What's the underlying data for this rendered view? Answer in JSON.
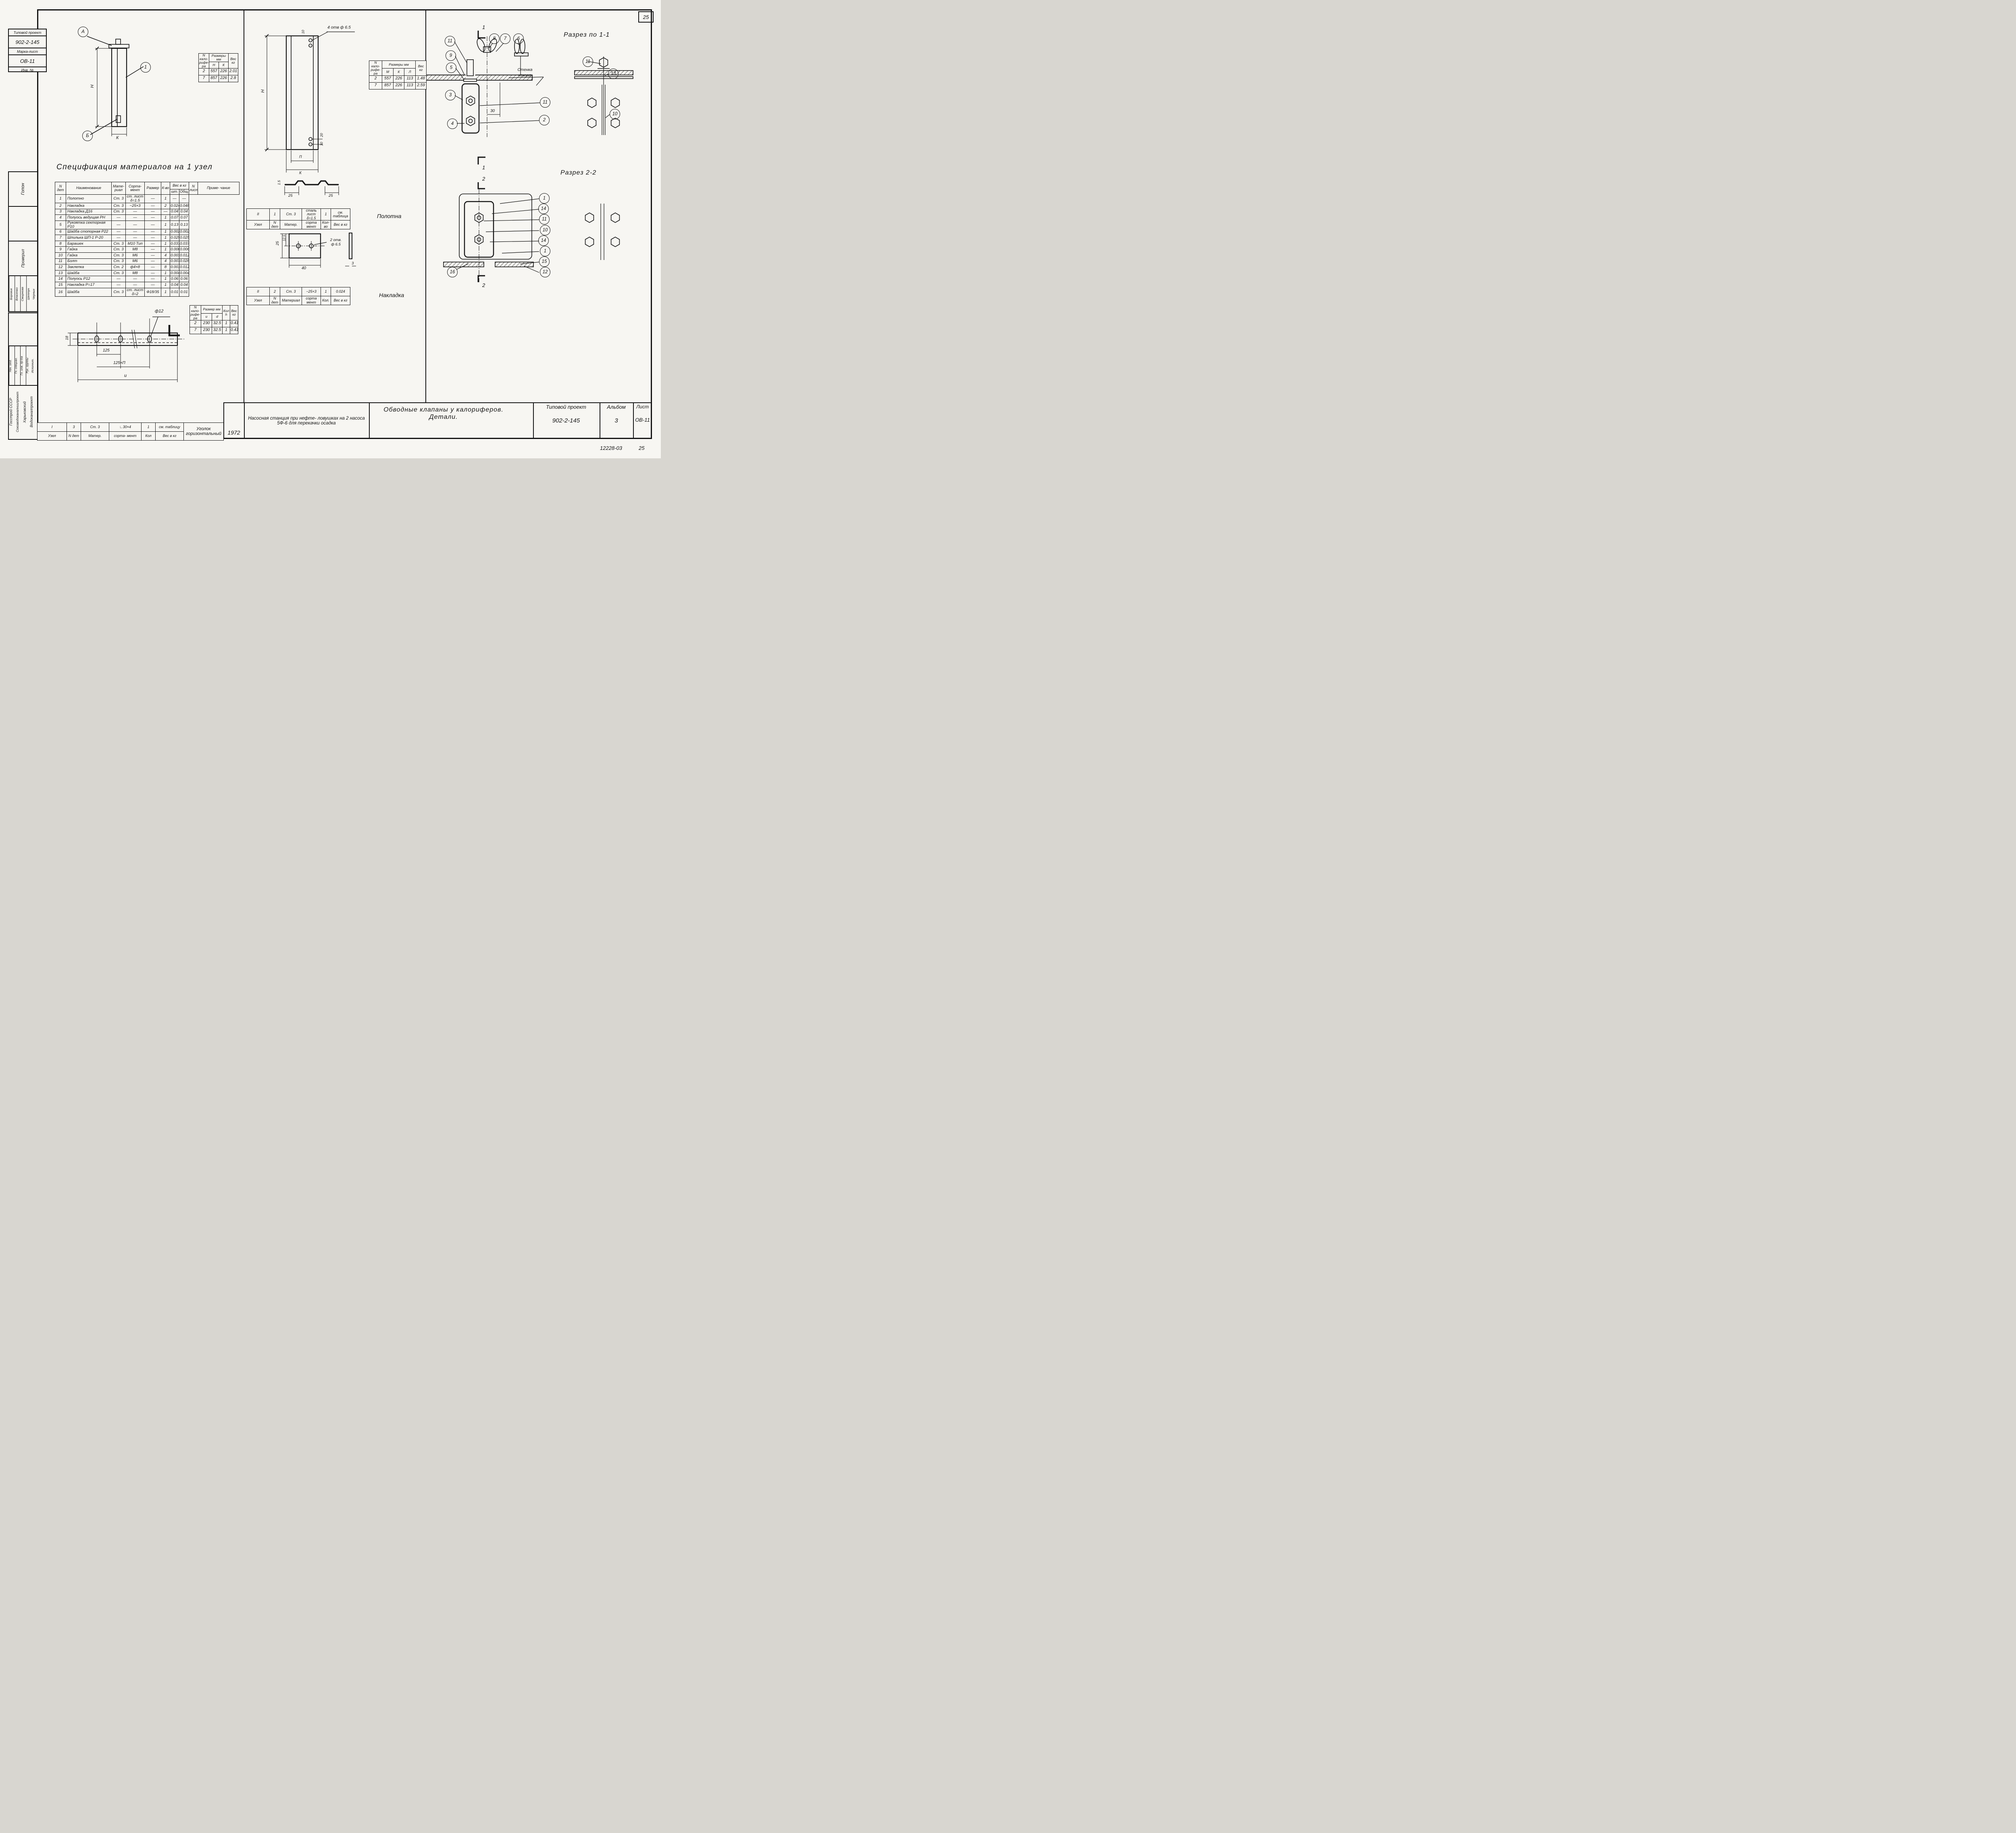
{
  "sheet": {
    "corner_number": "25",
    "footer_code": "12228-03",
    "footer_page": "25"
  },
  "corner_stamp": {
    "line1": "Типовой проект",
    "line2": "902-2-145",
    "line3": "Марка-лист",
    "line4": "ОВ-11",
    "line5": "Инв. №"
  },
  "left_stamp": {
    "approver": "Гопон",
    "checked_label": "Проверил",
    "names": [
      "Боровик",
      "Власенко",
      "Смирнова",
      "Шептун",
      "Черных"
    ],
    "roles": [
      "Нач. отд.",
      "Гл. специал.",
      "Гл. инж. пр-та",
      "Рук. группы",
      "Исполнит."
    ],
    "org": [
      "Госстрой СССР",
      "Союзводоканалниипроект",
      "Харьковский",
      "Водоканалпроект"
    ]
  },
  "spec": {
    "title": "Спецификация материалов на 1 узел",
    "h_num": "N дет",
    "h_name": "Наименование",
    "h_mat": "Мате- риал",
    "h_sort": "Сорта- мент",
    "h_size": "Размер",
    "h_qty": "К-во",
    "h_weight": "Вес в кг",
    "h_w_ea": "шт.",
    "h_w_tot": "Общ.",
    "h_sheet": "N листа",
    "h_note": "Приме- чание",
    "rows": [
      [
        "1",
        "Полотно",
        "Ст. 3",
        "ст. лист δ=1.5",
        "—",
        "1",
        "—",
        "—"
      ],
      [
        "2",
        "Накладка",
        "Ст. 3",
        "−25×3",
        "—",
        "2",
        "0.024",
        "0.048"
      ],
      [
        "3",
        "Накладка Д16",
        "Ст. 3",
        "—",
        "—",
        "—",
        "0.04",
        "0.04"
      ],
      [
        "4",
        "Полуось ведущая РН",
        "—",
        "—",
        "—",
        "1",
        "0.07",
        "0.07"
      ],
      [
        "5",
        "Рукоятка секторная Р10",
        "—",
        "—",
        "—",
        "1",
        "0.13",
        "0.13"
      ],
      [
        "6",
        "Шайба стопорная Р22",
        "—",
        "—",
        "—",
        "1",
        "0.002",
        "0.002"
      ],
      [
        "7",
        "Шпилька ШП-1 Р-20",
        "—",
        "—",
        "—",
        "1",
        "0.025",
        "0.025"
      ],
      [
        "8",
        "Барашек",
        "Ст. 3",
        "М10 Тип",
        "—",
        "1",
        "0.037",
        "0.037"
      ],
      [
        "9",
        "Гайка",
        "Ст. 3",
        "М8",
        "—",
        "1",
        "0.006",
        "0.006"
      ],
      [
        "10",
        "Гайка",
        "Ст. 3",
        "М6",
        "—",
        "4",
        "0.003",
        "0.012"
      ],
      [
        "11",
        "Болт",
        "Ст. 3",
        "М6",
        "—",
        "4",
        "0.007",
        "0.028"
      ],
      [
        "12",
        "Заклепка",
        "Ст. 2",
        "ф4×8",
        "—",
        "8",
        "0.0015",
        "0.012"
      ],
      [
        "13",
        "Шайба",
        "Ст. 3",
        "М8",
        "—",
        "1",
        "0.004",
        "0.004"
      ],
      [
        "14",
        "Полуось Р12",
        "—",
        "—",
        "—",
        "1",
        "0.06",
        "0.06"
      ],
      [
        "15",
        "Накладка Р=17",
        "—",
        "—",
        "—",
        "1",
        "0.04",
        "0.04"
      ],
      [
        "16",
        "Шайба",
        "Ст. 3",
        "ст. лист δ=2",
        "Ф18/35",
        "1",
        "0.01",
        "0.01"
      ]
    ]
  },
  "table_hk": {
    "h_col": "N кало- рифе- ра",
    "h_size": "Размеры мм",
    "c1": "Н",
    "c2": "К",
    "h_w": "Вес кг",
    "rows": [
      [
        "2",
        "557",
        "226",
        "2.01"
      ],
      [
        "7",
        "857",
        "226",
        "2.8"
      ]
    ]
  },
  "table_mkl": {
    "h_col": "N кало- рифе- ра",
    "h_size": "Размеры мм",
    "c1": "М",
    "c2": "К",
    "c3": "Л",
    "h_w": "Вес кг",
    "rows": [
      [
        "2",
        "557",
        "226",
        "113",
        "1.48"
      ],
      [
        "7",
        "857",
        "226",
        "113",
        "2.59"
      ]
    ]
  },
  "table_ud": {
    "h_col": "N кало- рифе- ра",
    "h_size": "Размер мм",
    "c1": "и",
    "c2": "d",
    "h_qty": "Кол h",
    "h_w": "Вес кг",
    "rows": [
      [
        "2",
        "230",
        "32.5",
        "1",
        "0.41"
      ],
      [
        "7",
        "230",
        "32.5",
        "1",
        "0.41"
      ]
    ]
  },
  "strip_polotna": {
    "caption": "Полотна",
    "rows": [
      [
        "II",
        "1",
        "Ст. 3",
        "сталь лист δ=1.5",
        "1",
        "см. таблица"
      ],
      [
        "Узел",
        "N дет",
        "Матер.",
        "сорта мент",
        "Кол-во",
        "Вес в кг"
      ]
    ]
  },
  "strip_nakladka": {
    "caption": "Накладка",
    "rows": [
      [
        "II",
        "2",
        "Ст. 3",
        "−25×3",
        "1",
        "0.024"
      ],
      [
        "Узел",
        "N дет",
        "Материал",
        "сорта мент",
        "Кол.",
        "Вес в кг"
      ]
    ]
  },
  "strip_ugolok": {
    "caption": "Уголок горизонтальный",
    "v": [
      "I",
      "3",
      "Ст. 3",
      "∟30×4",
      "1",
      "см. таблицу"
    ],
    "l": [
      "Узел",
      "N дет",
      "Матер.",
      "сорта- мент",
      "Кол",
      "Вес в кг"
    ]
  },
  "title_block": {
    "year": "1972",
    "project": "Насосная станция при нефте- ловушках на 2 насоса 5Ф-6 для перекачки осадка",
    "title": "Обводные клапаны у калориферов. Детали.",
    "tp_label": "Типовой проект",
    "tp_value": "902-2-145",
    "album_label": "Альбом",
    "album_value": "3",
    "sheet_label": "Лист",
    "sheet_value": "ОВ-11"
  },
  "d1": {
    "dim_h": "Н",
    "dim_k": "К",
    "callout_a": "А",
    "callout_b": "Б",
    "callout_1": "1"
  },
  "d2": {
    "holes": "4 отв ф 6.5",
    "dim_h": "Н",
    "dim_k": "К",
    "dim_p": "П",
    "dim_top": "10",
    "dim_b20": "20",
    "dim_b10": "10",
    "p25a": "25",
    "p25b": "25",
    "p15": "1.5"
  },
  "d3": {
    "dim25": "25",
    "dim125": "12.5",
    "dim40": "40",
    "dim3": "3",
    "holes_l1": "2 отв.",
    "holes_l2": "ф 6.5"
  },
  "d6": {
    "dim18": "18",
    "dia": "ф12",
    "dim125": "125",
    "dim125n": "125×П",
    "dim_u": "и"
  },
  "sec11": {
    "title": "Разрез по 1-1",
    "wall_l1": "Стенка",
    "wall_l2": "кожуха",
    "dim30": "30",
    "mark_top": "1",
    "mark_bot": "1",
    "c11": "11",
    "c9": "9",
    "c5": "5",
    "c3": "3",
    "c4": "4",
    "c8": "8",
    "c7": "7",
    "c6": "6",
    "m11": "11",
    "m2": "2",
    "r11": "11",
    "r13": "13",
    "r10": "10"
  },
  "sec22": {
    "title": "Разрез 2-2",
    "mark_top": "2",
    "mark_bot": "2",
    "c16": "16",
    "stack": [
      "1",
      "14",
      "11",
      "10",
      "14",
      "1",
      "15",
      "12"
    ]
  }
}
